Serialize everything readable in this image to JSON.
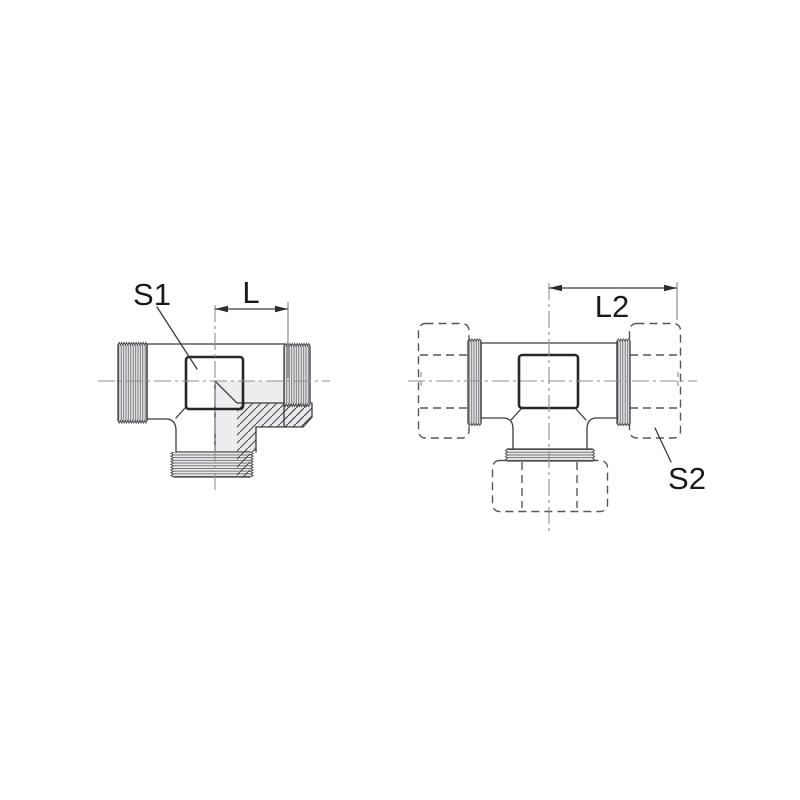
{
  "diagram": {
    "labels": {
      "s1": "S1",
      "l": "L",
      "l2": "L2",
      "s2": "S2"
    },
    "colors": {
      "line": "#3c3c3e",
      "dark_outline": "#27272a",
      "section_fill": "#e9e9eb",
      "hatch": "#4b4b4d",
      "centerline": "#8f8f92",
      "phantom_dash": "#57575a",
      "text": "#1a1a1c",
      "background": "#ffffff"
    }
  }
}
